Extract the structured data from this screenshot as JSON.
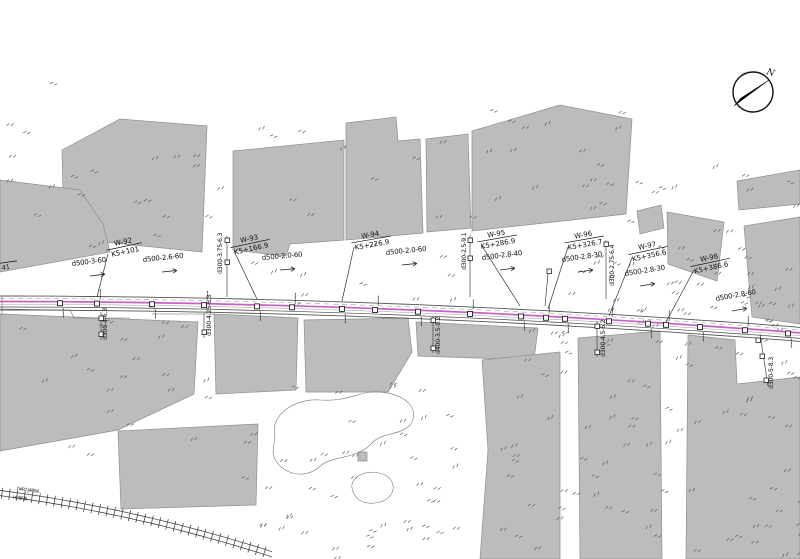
{
  "page": {
    "background": "#ffffff"
  },
  "north": {
    "label": "N"
  },
  "partial_station": {
    "value": "41"
  },
  "manholes": [
    {
      "id": "W-92",
      "station": "K5+101"
    },
    {
      "id": "W-93",
      "station": "K5+166.9"
    },
    {
      "id": "W-94",
      "station": "K5+226.9"
    },
    {
      "id": "W-95",
      "station": "K5+286.9"
    },
    {
      "id": "W-96",
      "station": "K5+326.7"
    },
    {
      "id": "W-97",
      "station": "K5+356.6"
    },
    {
      "id": "W-98",
      "station": "K5+386.6"
    }
  ],
  "pipes": [
    "d500-3-60",
    "d500-2.6-60",
    "d500-2.0-60",
    "d500-2.0-60",
    "d500-2.8-40",
    "d500-2.8-30",
    "d500-2.8-30",
    "d500-2.8-60"
  ],
  "branches": [
    "d300-4-6.3",
    "d300-4.25-6.3",
    "d300-3.75-6.3",
    "d400-3.5-9.2",
    "d300-2.5-9.1",
    "d300-4.5-6.2",
    "d300-2.75-6.4",
    "d300-5-8.3"
  ],
  "railway": {
    "line1": "7#R7:J48S4.",
    "line2": "I·6!8F/8."
  },
  "colors": {
    "pipeline": "#c75fc7",
    "parcel": "#bcbcbc",
    "north_n": "#c0392b"
  }
}
